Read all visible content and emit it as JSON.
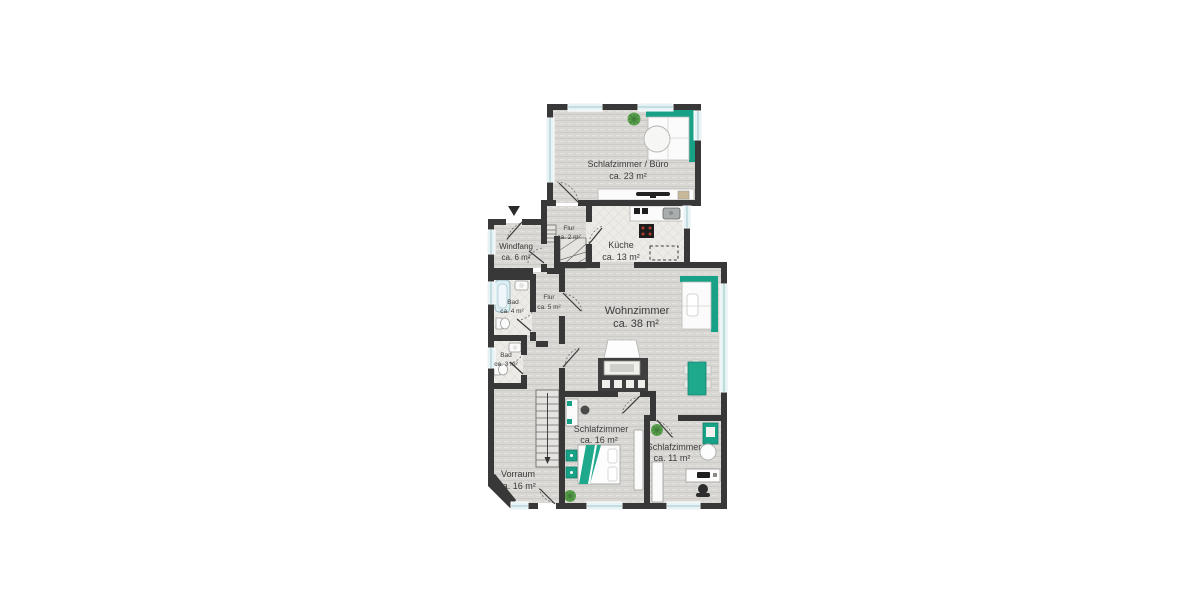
{
  "title": "Grundriss Erdgeschoss",
  "colors": {
    "wall": "#383838",
    "floor_wood": "#d8d7d3",
    "floor_tile": "#edebe7",
    "accent_teal": "#17a287",
    "window_glass": "#e6f2f4",
    "plant_green": "#5aa04f",
    "background": "#ffffff"
  },
  "markers": {
    "entry_arrow": "▼"
  },
  "rooms": [
    {
      "name": "Schlafzimmer / Büro",
      "area": "ca. 23 m²"
    },
    {
      "name": "Flur",
      "area": "ca. 2 m²"
    },
    {
      "name": "Windfang",
      "area": "ca. 6 m²"
    },
    {
      "name": "Küche",
      "area": "ca. 13 m²"
    },
    {
      "name": "Bad",
      "area": "ca. 4 m²"
    },
    {
      "name": "Flur",
      "area": "ca. 5 m²"
    },
    {
      "name": "Wohnzimmer",
      "area": "ca. 38 m²"
    },
    {
      "name": "Bad",
      "area": "ca. 3 m²"
    },
    {
      "name": "Vorraum",
      "area": "ca. 16 m²"
    },
    {
      "name": "Schlafzimmer",
      "area": "ca. 16 m²"
    },
    {
      "name": "Schlafzimmer",
      "area": "ca. 11 m²"
    }
  ],
  "furniture": {
    "schlafzimmer_buero": [
      "corner-sofa",
      "round-table",
      "plant",
      "sideboard-tv"
    ],
    "kueche": [
      "kitchen-counter",
      "sink",
      "stove",
      "planned-island-dashed"
    ],
    "wohnzimmer": [
      "corner-sofa",
      "dining-table",
      "dining-chairs",
      "tiled-stove",
      "armchair"
    ],
    "bad_4": [
      "bathtub",
      "washbasin",
      "wc"
    ],
    "bad_3": [
      "washbasin",
      "wc"
    ],
    "flur_2": [
      "entry-steps",
      "winder-stairs"
    ],
    "vorraum": [
      "staircase-down"
    ],
    "schlafzimmer_16": [
      "double-bed",
      "nightstands",
      "desk",
      "stool",
      "wardrobe",
      "plant"
    ],
    "schlafzimmer_11": [
      "wardrobe",
      "wall-shelf",
      "round-chair",
      "desk",
      "office-chair",
      "plant"
    ]
  }
}
